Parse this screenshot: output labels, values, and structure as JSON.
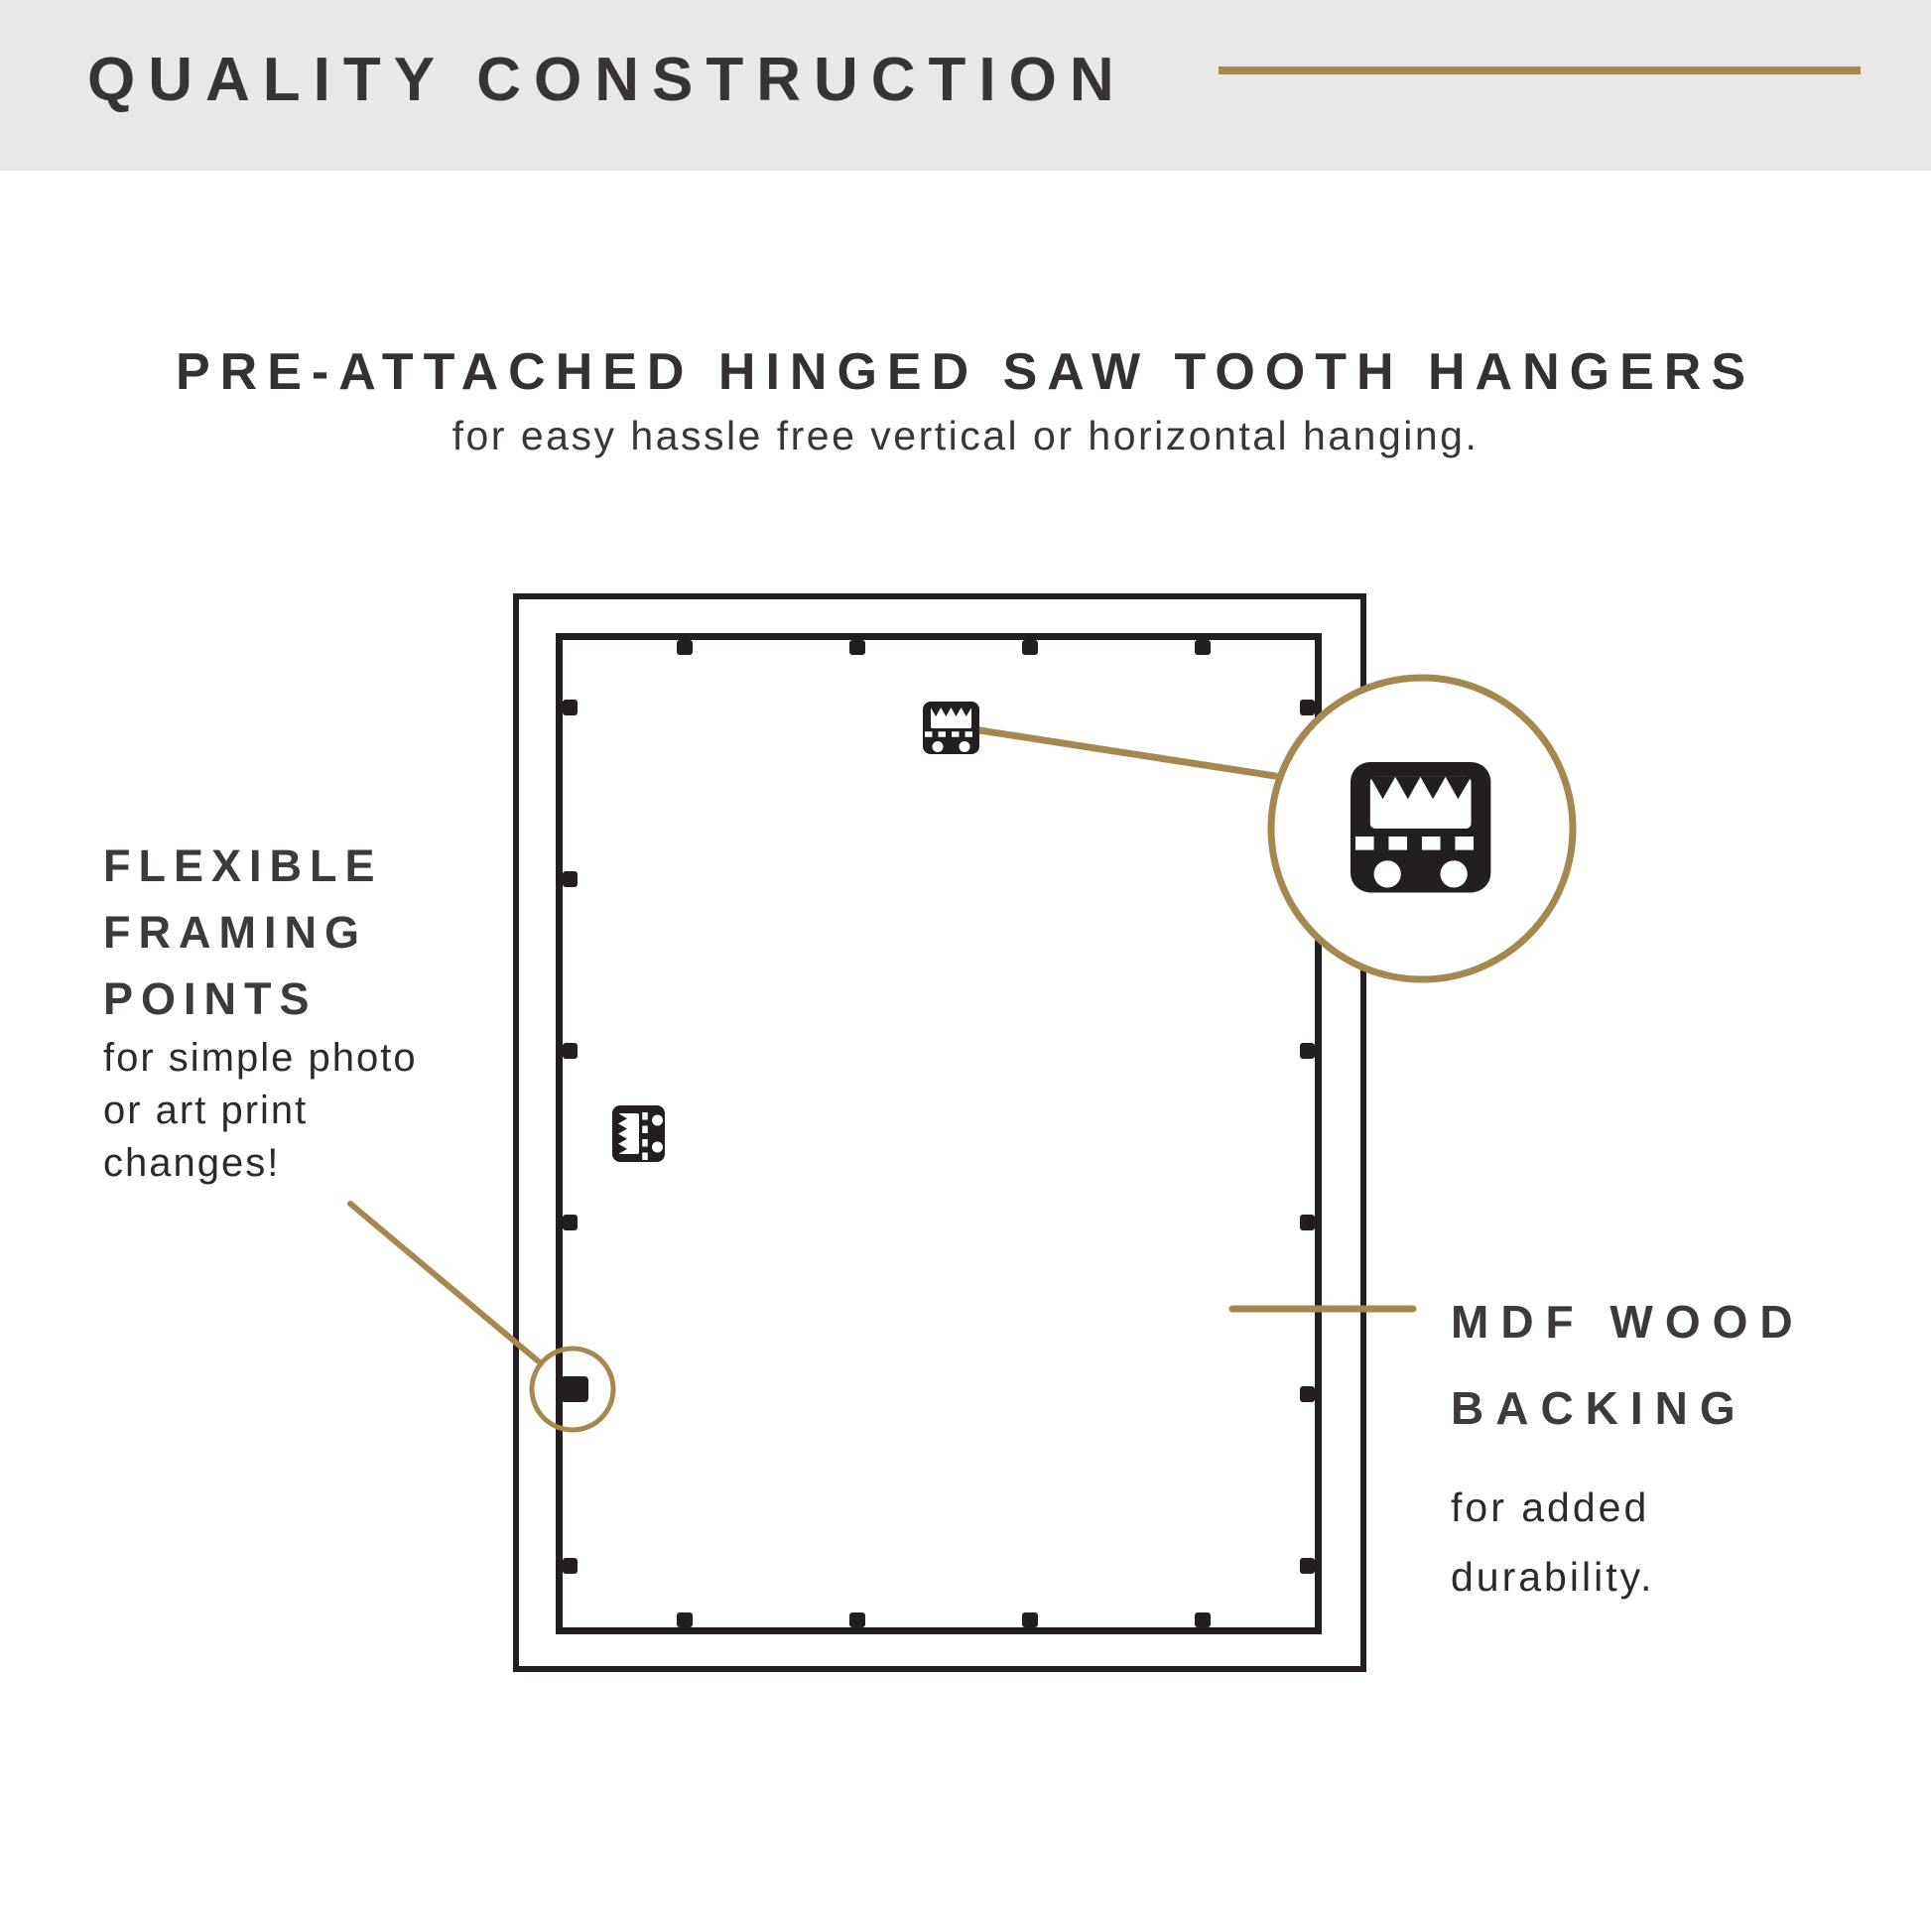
{
  "header": {
    "title": "QUALITY CONSTRUCTION"
  },
  "hero": {
    "title": "PRE-ATTACHED HINGED SAW TOOTH HANGERS",
    "subtitle": "for easy hassle free vertical or horizontal hanging."
  },
  "callouts": {
    "flexible_framing_points": {
      "title_lines": [
        "FLEXIBLE",
        "FRAMING",
        "POINTS"
      ],
      "body_lines": [
        "for simple photo",
        "or art print",
        "changes!"
      ]
    },
    "mdf_wood_backing": {
      "title_lines": [
        "MDF WOOD",
        "BACKING"
      ],
      "body_lines": [
        "for added",
        "durability."
      ]
    }
  },
  "diagram": {
    "description": "Back view of picture frame",
    "icons": [
      "sawtooth-hanger-icon",
      "hinged-sawtooth-hanger-icon",
      "magnified-sawtooth-hanger-icon",
      "framing-point-tab",
      "highlight-circle"
    ]
  },
  "colors": {
    "accent_gold": "#A5884D",
    "ink": "#231F20",
    "header_bg": "#E9E7E8",
    "heading_text": "#383435",
    "body_text": "#2E2A2B"
  }
}
